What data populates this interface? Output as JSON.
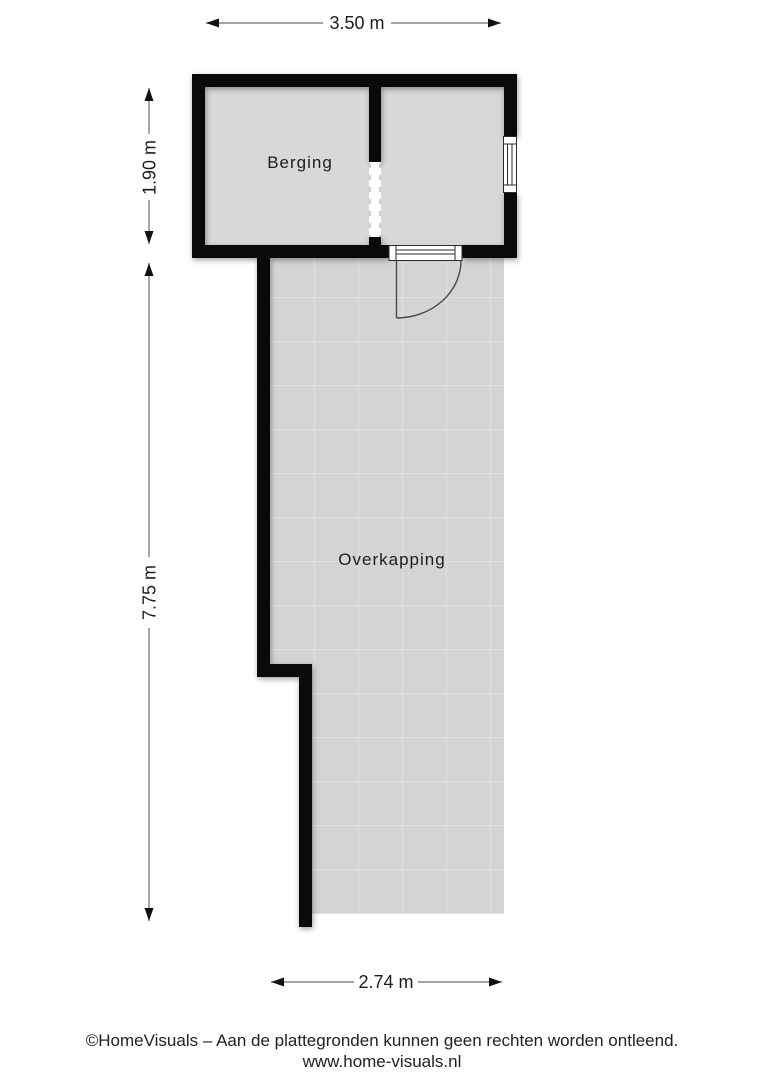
{
  "plan": {
    "title": "floor plan",
    "rooms": {
      "berging": {
        "label": "Berging"
      },
      "overkapping": {
        "label": "Overkapping"
      }
    },
    "dimensions": {
      "top": {
        "label": "3.50 m"
      },
      "left_upper": {
        "label": "1.90 m"
      },
      "left_lower": {
        "label": "7.75 m"
      },
      "bottom": {
        "label": "2.74 m"
      }
    },
    "symbols": [
      "door",
      "window",
      "passage-opening"
    ]
  },
  "footer": {
    "line1": "©HomeVisuals – Aan de plattegronden kunnen geen rechten worden ontleend.",
    "line2": "www.home-visuals.nl"
  },
  "colors": {
    "wall": "#0a0a0a",
    "room_fill": "#d8d8d8",
    "floor_fill": "#d4d4d4",
    "tile_line": "#e0e0e0",
    "dim_line": "#6e6e6e",
    "arrow": "#111111",
    "text": "#1c1c1c"
  }
}
